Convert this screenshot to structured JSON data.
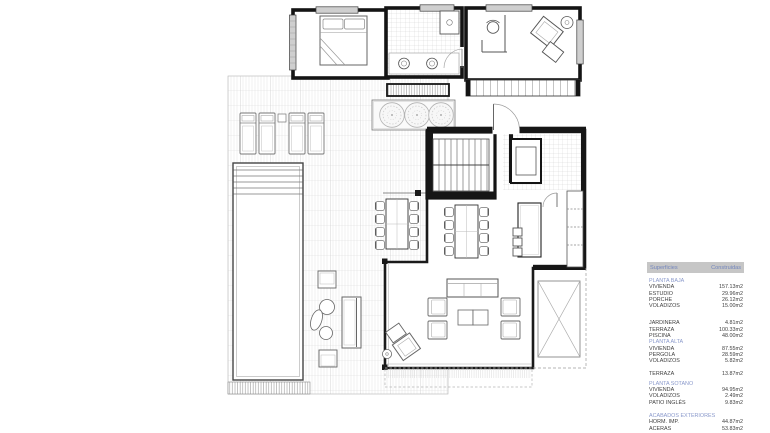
{
  "surfaces_table": {
    "headers": [
      "Superficies",
      "Construidas"
    ],
    "colors": {
      "header_bg": "#c6c6c6",
      "header_text": "#7285bd",
      "section_title_text": "#8a99cb",
      "row_text": "#3f3f3f"
    },
    "sections": [
      {
        "title": "PLANTA BAJA",
        "gap_px": 0,
        "rows": [
          {
            "label": "VIVIENDA",
            "value": "157.13m2"
          },
          {
            "label": "ESTUDIO",
            "value": "29.96m2"
          },
          {
            "label": "PORCHE",
            "value": "26.12m2"
          },
          {
            "label": "VOLADIZOS",
            "value": "15.00m2"
          }
        ]
      },
      {
        "title": "",
        "gap_px": 11,
        "rows": [
          {
            "label": "JARDINERA",
            "value": "4.81m2"
          },
          {
            "label": "TERRAZA",
            "value": "100.33m2"
          },
          {
            "label": "PISCINA",
            "value": "48.00m2"
          }
        ]
      },
      {
        "title": "PLANTA ALTA",
        "gap_px": 0,
        "rows": [
          {
            "label": "VIVIENDA",
            "value": "87.55m2"
          },
          {
            "label": "PERGOLA",
            "value": "28.59m2"
          },
          {
            "label": "VOLADIZOS",
            "value": "5.82m2"
          }
        ]
      },
      {
        "title": "",
        "gap_px": 6,
        "rows": [
          {
            "label": "TERRAZA",
            "value": "13.87m2"
          }
        ]
      },
      {
        "title": "PLANTA SOTANO",
        "gap_px": 4,
        "rows": [
          {
            "label": "VIVIENDA",
            "value": "94.95m2"
          },
          {
            "label": "VOLADIZOS",
            "value": "2.49m2"
          },
          {
            "label": "PATIO INGLÉS",
            "value": "9.83m2"
          }
        ]
      },
      {
        "title": "ACABADOS EXTERIORES",
        "gap_px": 7,
        "rows": [
          {
            "label": "HORM. IMP.",
            "value": "44.87m2"
          },
          {
            "label": "ACERAS",
            "value": "53.83m2"
          }
        ]
      }
    ]
  },
  "plan": {
    "type": "architectural-floor-plan",
    "colors": {
      "wall": "#161616",
      "furniture_line": "#666666",
      "deck_hatch": "#e2e2e2",
      "tile_hatch": "#d2d2d2"
    },
    "features": [
      "terrace-deck",
      "swimming-pool",
      "pool-steps",
      "sun-loungers",
      "planter-with-trees",
      "master-bedroom",
      "bed",
      "bathroom",
      "double-sinks",
      "shower",
      "studio",
      "desk-and-chair",
      "lounge-armchair",
      "balcony-strip",
      "entrance-door",
      "staircase",
      "kitchen",
      "kitchen-island-with-stools",
      "indoor-dining-table",
      "outdoor-dining-table",
      "living-room-sofas",
      "coffee-table",
      "reading-corner",
      "outdoor-lounge-set",
      "pergola-void",
      "porch-edge"
    ]
  }
}
